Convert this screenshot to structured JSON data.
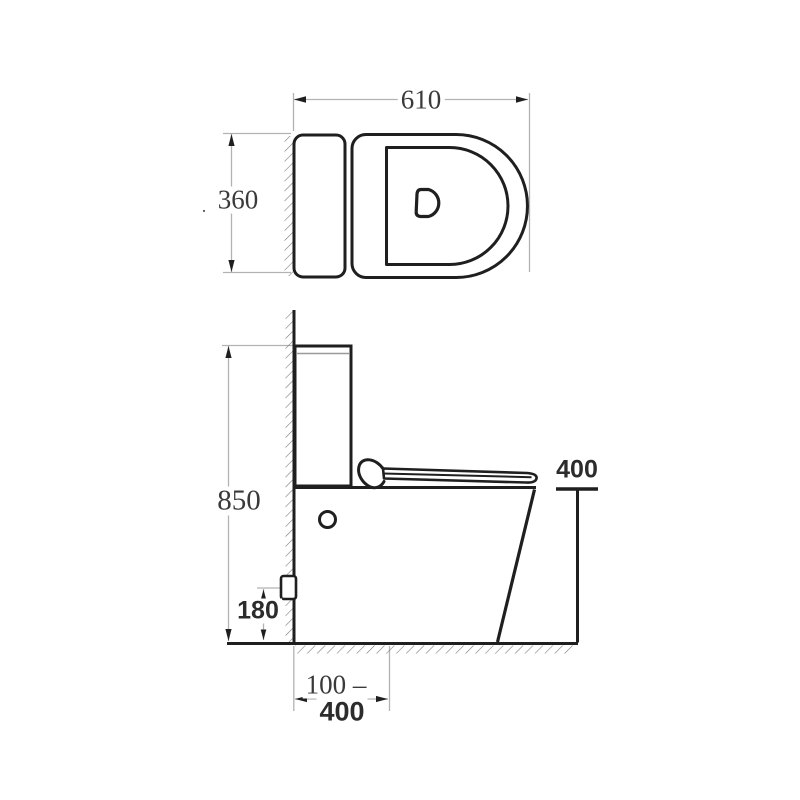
{
  "canvas": {
    "width": 800,
    "height": 800,
    "background": "#ffffff"
  },
  "diagram": {
    "kind": "technical dimension drawing",
    "subject": "two-piece toilet, top view and side view",
    "colors": {
      "object_line": "#1f1f1f",
      "dimension_line": "#b2b2b2",
      "hatch": "#7d7d7d",
      "label_text": "#3a3a3a",
      "bold_label_text": "#2c2c2c"
    },
    "labels": {
      "top_view_length": "610",
      "top_view_width": "360",
      "top_view_width_dot": ".",
      "overall_height": "850",
      "seat_height": "400",
      "inlet_height": "180",
      "outlet_setout_line1": "100 –",
      "outlet_setout_line2": "400"
    }
  }
}
